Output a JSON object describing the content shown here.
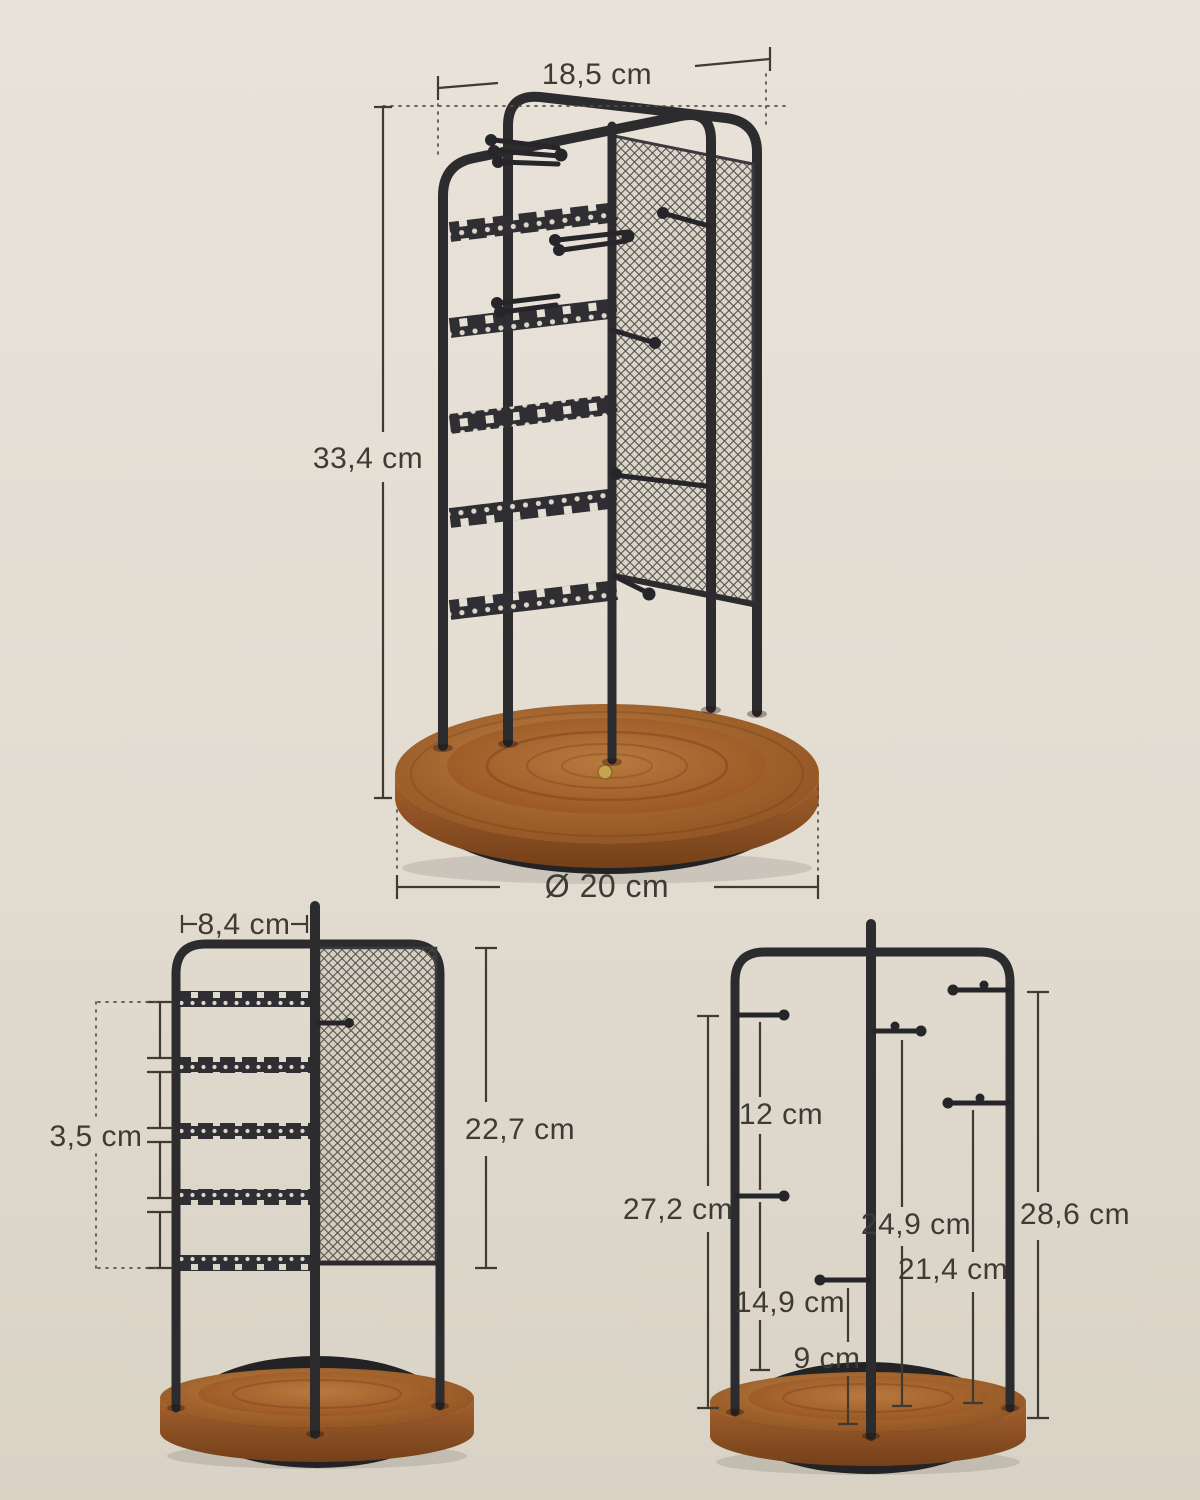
{
  "main_view": {
    "top_width_label": "18,5 cm",
    "height_label": "33,4 cm",
    "base_diameter_label": "Ø 20 cm"
  },
  "front_view": {
    "earring_bar_width_label": "8,4 cm",
    "bar_spacing_label": "3,5 cm",
    "mesh_panel_height_label": "22,7 cm"
  },
  "side_view": {
    "left_hook_gap_label": "12 cm",
    "left_upper_hook_height_label": "27,2 cm",
    "center_lower_hook_height_label": "14,9 cm",
    "center_bottom_hook_height_label": "9 cm",
    "center_upper_hook_height_label": "24,9 cm",
    "right_lower_hook_height_label": "21,4 cm",
    "right_upper_hook_height_label": "28,6 cm"
  },
  "colors": {
    "background_top": "#e8e2d9",
    "background_bottom": "#d9d2c5",
    "metal_frame": "#2c2c2f",
    "mesh_line": "#56534a",
    "dimension_text": "#3e3b35",
    "wood_light": "#c08048",
    "wood_dark": "#7b431c",
    "base_bottom_disk": "#232326",
    "brass_button": "#c9a24f"
  }
}
